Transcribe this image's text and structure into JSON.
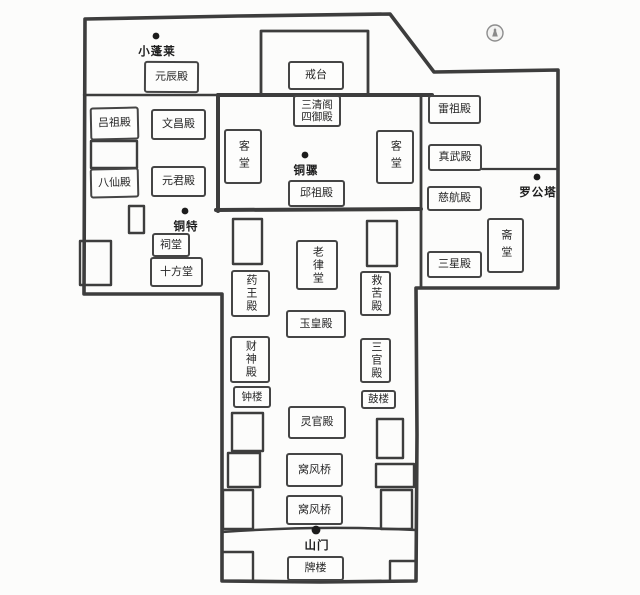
{
  "map": {
    "halls": {
      "yuanchen": "元辰殿",
      "lvzu": "吕祖殿",
      "wenchang": "文昌殿",
      "baxian": "八仙殿",
      "yuanjun": "元君殿",
      "citang": "祠堂",
      "shifang": "十方堂",
      "jietai": "戒台",
      "sanqing_line1": "三清阁",
      "sanqing_line2": "四御殿",
      "ketang_west": "客堂",
      "ketang_east": "客堂",
      "qiuzu": "邱祖殿",
      "leizu": "雷祖殿",
      "zhenwu": "真武殿",
      "cihang": "慈航殿",
      "sanxing": "三星殿",
      "zhaitang": "斋堂",
      "laolv": "老律堂",
      "yaowang": "药王殿",
      "jiuku": "救苦殿",
      "yuhuang": "玉皇殿",
      "caishen": "财神殿",
      "sanguan": "三官殿",
      "zhonglou": "钟楼",
      "gulou": "鼓楼",
      "lingguan": "灵官殿",
      "wofengqiao_1": "窝风桥",
      "wofengqiao_2": "窝风桥",
      "pailou": "牌楼"
    },
    "landmarks": {
      "xiaopenglai": "小蓬莱",
      "tongluo": "铜骡",
      "tongte": "铜特",
      "luogongta": "罗公塔",
      "shanmen": "山门"
    },
    "icons": {
      "compass": "compass-emblem"
    },
    "colors": {
      "wall": "#3d3d3d",
      "text": "#222222",
      "paper": "#fcfcfb"
    }
  }
}
